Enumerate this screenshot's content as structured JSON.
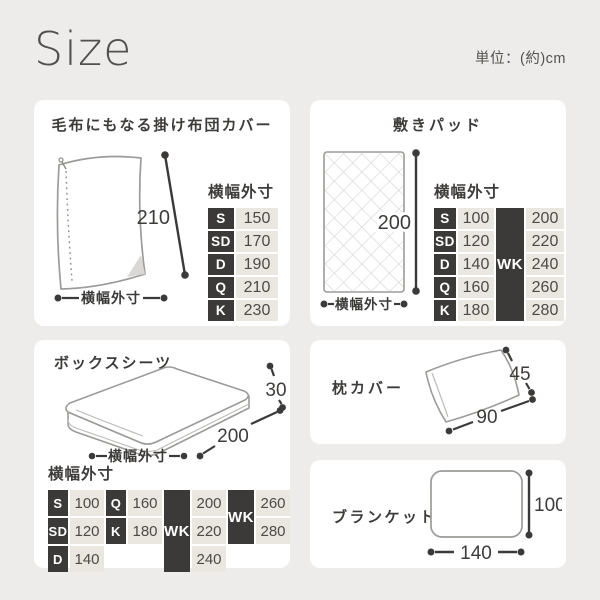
{
  "page": {
    "title": "Size",
    "unit_note": "単位：(約)cm"
  },
  "duvet_card": {
    "title": "毛布にもなる掛け布団カバー",
    "length_value": "210",
    "width_label": "横幅外寸",
    "table_header": "横幅外寸",
    "rows": [
      {
        "size": "S",
        "value": "150"
      },
      {
        "size": "SD",
        "value": "170"
      },
      {
        "size": "D",
        "value": "190"
      },
      {
        "size": "Q",
        "value": "210"
      },
      {
        "size": "K",
        "value": "230"
      }
    ]
  },
  "pad_card": {
    "title": "敷きパッド",
    "length_value": "200",
    "width_label": "横幅外寸",
    "table_header": "横幅外寸",
    "wk_label": "WK",
    "rows": [
      {
        "size": "S",
        "value": "100",
        "wk_value": "200"
      },
      {
        "size": "SD",
        "value": "120",
        "wk_value": "220"
      },
      {
        "size": "D",
        "value": "140",
        "wk_value": "240"
      },
      {
        "size": "Q",
        "value": "160",
        "wk_value": "260"
      },
      {
        "size": "K",
        "value": "180",
        "wk_value": "280"
      }
    ]
  },
  "boxsheet_card": {
    "title": "ボックスシーツ",
    "height_value": "30",
    "depth_value": "200",
    "width_label": "横幅外寸",
    "table_header": "横幅外寸",
    "col1": [
      {
        "size": "S",
        "value": "100"
      },
      {
        "size": "SD",
        "value": "120"
      },
      {
        "size": "D",
        "value": "140"
      }
    ],
    "col2": [
      {
        "size": "Q",
        "value": "160"
      },
      {
        "size": "K",
        "value": "180"
      }
    ],
    "wk1": {
      "label": "WK",
      "values": [
        "200",
        "220",
        "240"
      ]
    },
    "wk2": {
      "label": "WK",
      "values": [
        "260",
        "280"
      ]
    }
  },
  "pillow_card": {
    "title": "枕カバー",
    "height_value": "45",
    "width_value": "90"
  },
  "blanket_card": {
    "title": "ブランケット",
    "height_value": "100",
    "width_value": "140"
  }
}
